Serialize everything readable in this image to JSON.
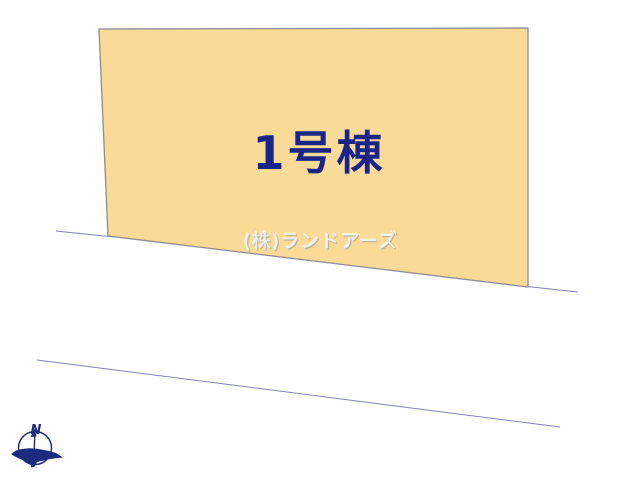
{
  "page": {
    "background": "#ffffff"
  },
  "lot": {
    "label": "1号棟"
  },
  "watermark": {
    "text": "(株)ランドアーズ"
  },
  "compass": {
    "north_label": "N"
  },
  "colors": {
    "lot_fill": "#f9da97",
    "lot_border": "#8d8d96",
    "boundary_line": "#8383b4",
    "lot_label_text": "#1b2588",
    "compass_navy": "#1c2b7e",
    "watermark_text": "#f0f0f0"
  }
}
